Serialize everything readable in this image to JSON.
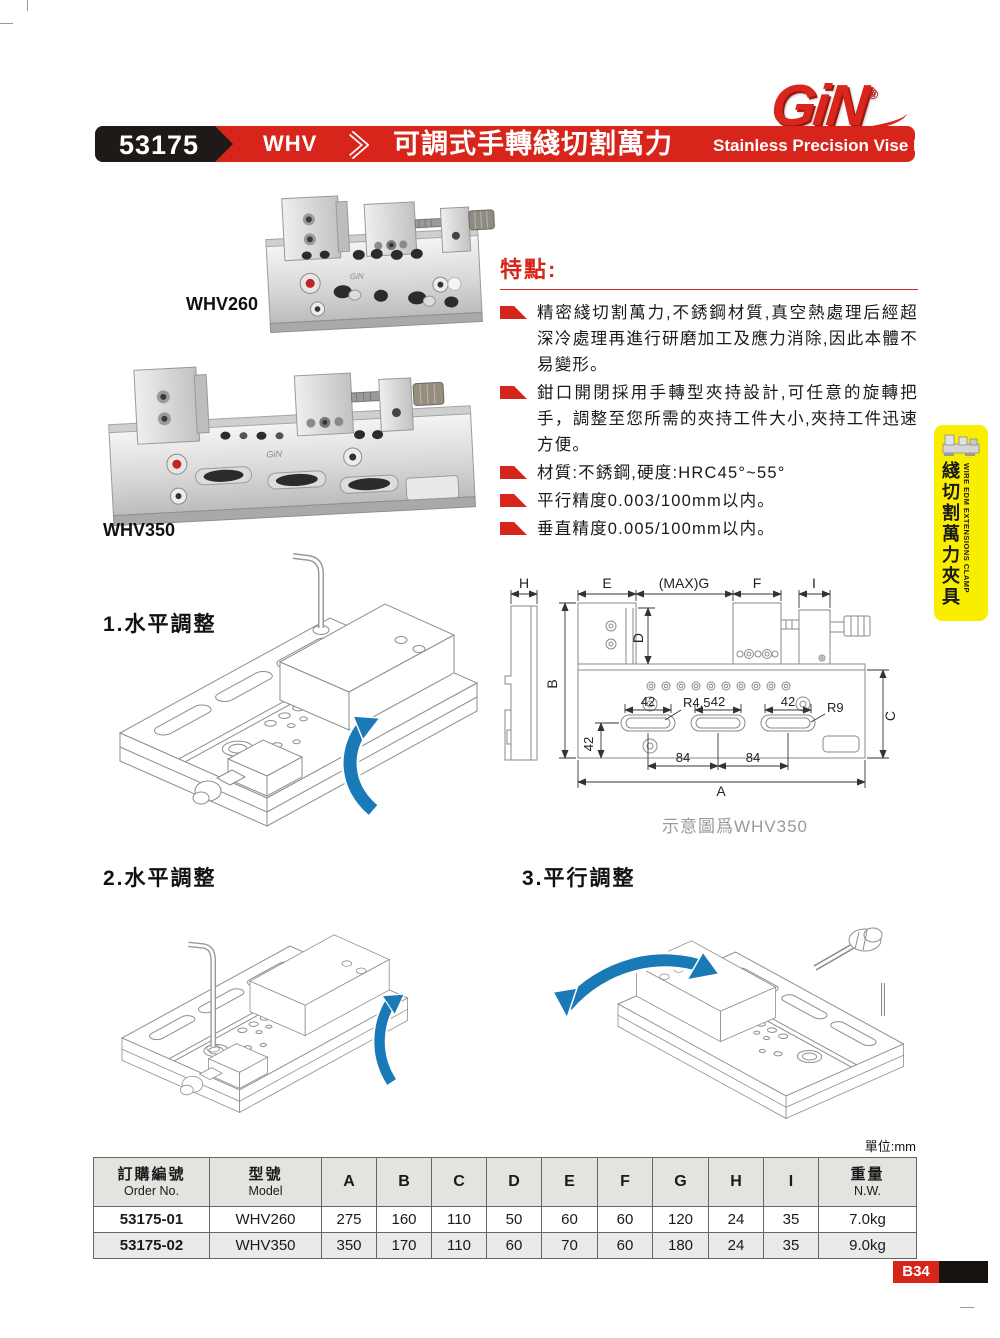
{
  "brand": {
    "name": "GiN",
    "registered": "®"
  },
  "header": {
    "code": "53175",
    "series": "WHV",
    "title_zh": "可調式手轉綫切割萬力",
    "title_en": "Stainless Precision Vise For EDM"
  },
  "products": [
    {
      "label": "WHV260"
    },
    {
      "label": "WHV350"
    }
  ],
  "features": {
    "heading": "特點:",
    "items": [
      "精密綫切割萬力,不銹鋼材質,真空熱處理后經超深冷處理再進行研磨加工及應力消除,因此本體不易變形。",
      "鉗口開閉採用手轉型夾持設計,可任意的旋轉把手，調整至您所需的夾持工件大小,夾持工件迅速方便。",
      "材質:不銹鋼,硬度:HRC45°~55°",
      "平行精度0.003/100mm以内。",
      "垂直精度0.005/100mm以内。"
    ]
  },
  "side_tab": {
    "zh": "綫切割萬力夾具",
    "en": "WIRE EDM EXTENSIONS CLAMP"
  },
  "steps": [
    {
      "label": "1.水平調整"
    },
    {
      "label": "2.水平調整"
    },
    {
      "label": "3.平行調整"
    }
  ],
  "diagram": {
    "caption": "示意圖爲WHV350",
    "labels": {
      "h": "H",
      "e": "E",
      "maxg": "(MAX)G",
      "f": "F",
      "i": "I",
      "b": "B",
      "d": "D",
      "c": "C",
      "a": "A",
      "n42a": "42",
      "n42b": "42",
      "n42c": "42",
      "n42v": "42",
      "r45": "R4.5",
      "r9": "R9",
      "n84a": "84",
      "n84b": "84"
    }
  },
  "table": {
    "unit_note": "單位:mm",
    "col_order_zh": "訂購編號",
    "col_order_en": "Order No.",
    "col_model_zh": "型號",
    "col_model_en": "Model",
    "dim_cols": [
      "A",
      "B",
      "C",
      "D",
      "E",
      "F",
      "G",
      "H",
      "I"
    ],
    "col_weight_zh": "重量",
    "col_weight_en": "N.W.",
    "rows": [
      {
        "order": "53175-01",
        "model": "WHV260",
        "values": [
          "275",
          "160",
          "110",
          "50",
          "60",
          "60",
          "120",
          "24",
          "35"
        ],
        "weight": "7.0kg"
      },
      {
        "order": "53175-02",
        "model": "WHV350",
        "values": [
          "350",
          "170",
          "110",
          "60",
          "70",
          "60",
          "180",
          "24",
          "35"
        ],
        "weight": "9.0kg"
      }
    ]
  },
  "footer": {
    "page": "B34"
  }
}
